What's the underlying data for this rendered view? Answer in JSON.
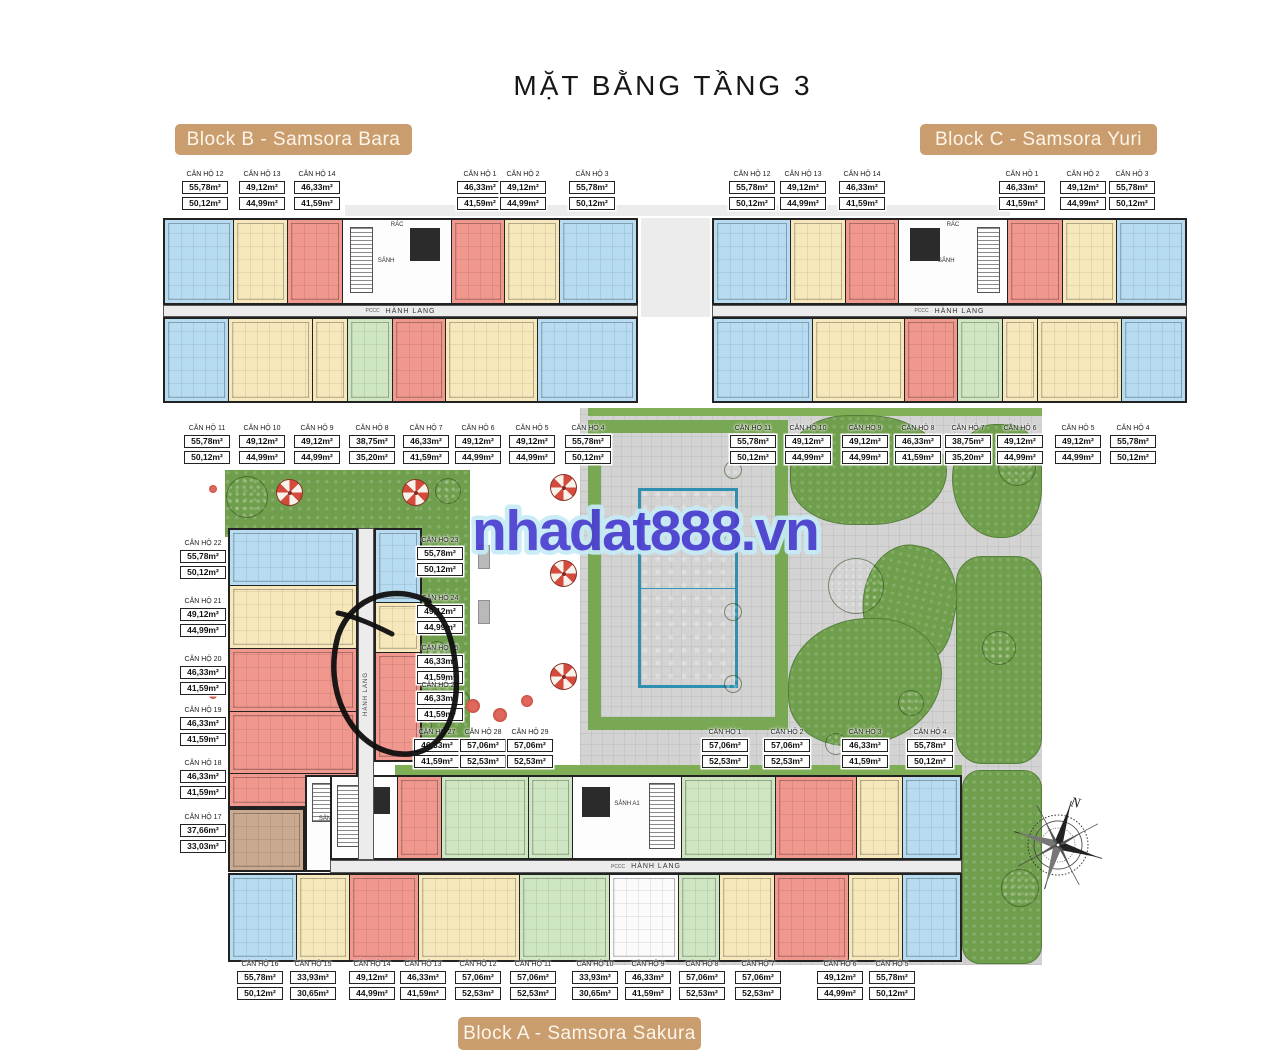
{
  "title": "MẶT BẰNG TẦNG 3",
  "watermark": "nhadat888.vn",
  "badges": {
    "block_b": "Block B - Samsora Bara",
    "block_c": "Block C - Samsora Yuri",
    "block_a": "Block A - Samsora Sakura"
  },
  "plan_texts": {
    "sanh": "SẢNH",
    "sanh_a1": "SẢNH A1",
    "sanh_a2": "SẢNH A2",
    "hanh_lang": "HÀNH LANG",
    "rac": "RÁC",
    "pccc": "PCCC"
  },
  "compass": {
    "label": "N"
  },
  "colors": {
    "accent_tan": "#c99d6e",
    "unit_blue": "#b7dcf2",
    "unit_cream": "#f7e8bc",
    "unit_red": "#f0978e",
    "unit_green": "#cfe6c2",
    "unit_brown": "#c9a98f",
    "pool": "#5fc9e2",
    "grass": "#7fae57",
    "garden": "#6f9e4c",
    "pavement": "#d3d3d3",
    "watermark_fill": "#4a3fd1",
    "watermark_outline": "#c6ebf6",
    "annotation": "#0f0f0f"
  },
  "label_groups": [
    {
      "name": "block-b-top",
      "labels": [
        {
          "unit": "CĂN HỘ 12",
          "area1": "55,78m²",
          "area2": "50,12m²",
          "x": 205,
          "y": 171
        },
        {
          "unit": "CĂN HỘ 13",
          "area1": "49,12m²",
          "area2": "44,99m²",
          "x": 262,
          "y": 171
        },
        {
          "unit": "CĂN HỘ 14",
          "area1": "46,33m²",
          "area2": "41,59m²",
          "x": 317,
          "y": 171
        },
        {
          "unit": "CĂN HỘ 1",
          "area1": "46,33m²",
          "area2": "41,59m²",
          "x": 480,
          "y": 171
        },
        {
          "unit": "CĂN HỘ 2",
          "area1": "49,12m²",
          "area2": "44,99m²",
          "x": 523,
          "y": 171
        },
        {
          "unit": "CĂN HỘ 3",
          "area1": "55,78m²",
          "area2": "50,12m²",
          "x": 592,
          "y": 171
        }
      ]
    },
    {
      "name": "block-c-top",
      "labels": [
        {
          "unit": "CĂN HỘ 12",
          "area1": "55,78m²",
          "area2": "50,12m²",
          "x": 752,
          "y": 171
        },
        {
          "unit": "CĂN HỘ 13",
          "area1": "49,12m²",
          "area2": "44,99m²",
          "x": 803,
          "y": 171
        },
        {
          "unit": "CĂN HỘ 14",
          "area1": "46,33m²",
          "area2": "41,59m²",
          "x": 862,
          "y": 171
        },
        {
          "unit": "CĂN HỘ 1",
          "area1": "46,33m²",
          "area2": "41,59m²",
          "x": 1022,
          "y": 171
        },
        {
          "unit": "CĂN HỘ 2",
          "area1": "49,12m²",
          "area2": "44,99m²",
          "x": 1083,
          "y": 171
        },
        {
          "unit": "CĂN HỘ 3",
          "area1": "55,78m²",
          "area2": "50,12m²",
          "x": 1132,
          "y": 171
        }
      ]
    },
    {
      "name": "block-b-mid",
      "labels": [
        {
          "unit": "CĂN HỘ 11",
          "area1": "55,78m²",
          "area2": "50,12m²",
          "x": 207,
          "y": 425
        },
        {
          "unit": "CĂN HỘ 10",
          "area1": "49,12m²",
          "area2": "44,99m²",
          "x": 262,
          "y": 425
        },
        {
          "unit": "CĂN HỘ 9",
          "area1": "49,12m²",
          "area2": "44,99m²",
          "x": 317,
          "y": 425
        },
        {
          "unit": "CĂN HỘ 8",
          "area1": "38,75m²",
          "area2": "35,20m²",
          "x": 372,
          "y": 425
        },
        {
          "unit": "CĂN HỘ 7",
          "area1": "46,33m²",
          "area2": "41,59m²",
          "x": 426,
          "y": 425
        },
        {
          "unit": "CĂN HỘ 6",
          "area1": "49,12m²",
          "area2": "44,99m²",
          "x": 478,
          "y": 425
        },
        {
          "unit": "CĂN HỘ 5",
          "area1": "49,12m²",
          "area2": "44,99m²",
          "x": 532,
          "y": 425
        },
        {
          "unit": "CĂN HỘ 4",
          "area1": "55,78m²",
          "area2": "50,12m²",
          "x": 588,
          "y": 425
        }
      ]
    },
    {
      "name": "block-c-mid",
      "labels": [
        {
          "unit": "CĂN HỘ 11",
          "area1": "55,78m²",
          "area2": "50,12m²",
          "x": 753,
          "y": 425
        },
        {
          "unit": "CĂN HỘ 10",
          "area1": "49,12m²",
          "area2": "44,99m²",
          "x": 808,
          "y": 425
        },
        {
          "unit": "CĂN HỘ 9",
          "area1": "49,12m²",
          "area2": "44,99m²",
          "x": 865,
          "y": 425
        },
        {
          "unit": "CĂN HỘ 8",
          "area1": "46,33m²",
          "area2": "41,59m²",
          "x": 918,
          "y": 425
        },
        {
          "unit": "CĂN HỘ 7",
          "area1": "38,75m²",
          "area2": "35,20m²",
          "x": 968,
          "y": 425
        },
        {
          "unit": "CĂN HỘ 6",
          "area1": "49,12m²",
          "area2": "44,99m²",
          "x": 1020,
          "y": 425
        },
        {
          "unit": "CĂN HỘ 5",
          "area1": "49,12m²",
          "area2": "44,99m²",
          "x": 1078,
          "y": 425
        },
        {
          "unit": "CĂN HỘ 4",
          "area1": "55,78m²",
          "area2": "50,12m²",
          "x": 1133,
          "y": 425
        }
      ]
    },
    {
      "name": "block-a-left",
      "labels": [
        {
          "unit": "CĂN HỘ 22",
          "area1": "55,78m²",
          "area2": "50,12m²",
          "x": 203,
          "y": 540
        },
        {
          "unit": "CĂN HỘ 21",
          "area1": "49,12m²",
          "area2": "44,99m²",
          "x": 203,
          "y": 598
        },
        {
          "unit": "CĂN HỘ 20",
          "area1": "46,33m²",
          "area2": "41,59m²",
          "x": 203,
          "y": 656
        },
        {
          "unit": "CĂN HỘ 19",
          "area1": "46,33m²",
          "area2": "41,59m²",
          "x": 203,
          "y": 707
        },
        {
          "unit": "CĂN HỘ 18",
          "area1": "46,33m²",
          "area2": "41,59m²",
          "x": 203,
          "y": 760
        },
        {
          "unit": "CĂN HỘ 17",
          "area1": "37,66m²",
          "area2": "33,03m²",
          "x": 203,
          "y": 814
        }
      ]
    },
    {
      "name": "block-a-center",
      "labels": [
        {
          "unit": "CĂN HỘ 23",
          "area1": "55,78m²",
          "area2": "50,12m²",
          "x": 440,
          "y": 537
        },
        {
          "unit": "CĂN HỘ 24",
          "area1": "49,12m²",
          "area2": "44,99m²",
          "x": 440,
          "y": 595
        },
        {
          "unit": "CĂN HỘ 25",
          "area1": "46,33m²",
          "area2": "41,59m²",
          "x": 440,
          "y": 645
        },
        {
          "unit": "CĂN HỘ 26",
          "area1": "46,33m²",
          "area2": "41,59m²",
          "x": 440,
          "y": 682
        }
      ]
    },
    {
      "name": "block-a-inner-row",
      "labels": [
        {
          "unit": "CĂN HỘ 27",
          "area1": "46,33m²",
          "area2": "41,59m²",
          "x": 437,
          "y": 729
        },
        {
          "unit": "CĂN HỘ 28",
          "area1": "57,06m²",
          "area2": "52,53m²",
          "x": 483,
          "y": 729
        },
        {
          "unit": "CĂN HỘ 29",
          "area1": "57,06m²",
          "area2": "52,53m²",
          "x": 530,
          "y": 729
        }
      ]
    },
    {
      "name": "block-a-right-row",
      "labels": [
        {
          "unit": "CĂN HỘ 1",
          "area1": "57,06m²",
          "area2": "52,53m²",
          "x": 725,
          "y": 729
        },
        {
          "unit": "CĂN HỘ 2",
          "area1": "57,06m²",
          "area2": "52,53m²",
          "x": 787,
          "y": 729
        },
        {
          "unit": "CĂN HỘ 3",
          "area1": "46,33m²",
          "area2": "41,59m²",
          "x": 865,
          "y": 729
        },
        {
          "unit": "CĂN HỘ 4",
          "area1": "55,78m²",
          "area2": "50,12m²",
          "x": 930,
          "y": 729
        }
      ]
    },
    {
      "name": "block-a-bottom",
      "labels": [
        {
          "unit": "CĂN HỘ 16",
          "area1": "55,78m²",
          "area2": "50,12m²",
          "x": 260,
          "y": 961
        },
        {
          "unit": "CĂN HỘ 15",
          "area1": "33,93m²",
          "area2": "30,65m²",
          "x": 313,
          "y": 961
        },
        {
          "unit": "CĂN HỘ 14",
          "area1": "49,12m²",
          "area2": "44,99m²",
          "x": 372,
          "y": 961
        },
        {
          "unit": "CĂN HỘ 13",
          "area1": "46,33m²",
          "area2": "41,59m²",
          "x": 423,
          "y": 961
        },
        {
          "unit": "CĂN HỘ 12",
          "area1": "57,06m²",
          "area2": "52,53m²",
          "x": 478,
          "y": 961
        },
        {
          "unit": "CĂN HỘ 11",
          "area1": "57,06m²",
          "area2": "52,53m²",
          "x": 533,
          "y": 961
        },
        {
          "unit": "CĂN HỘ 10",
          "area1": "33,93m²",
          "area2": "30,65m²",
          "x": 595,
          "y": 961
        },
        {
          "unit": "CĂN HỘ 9",
          "area1": "46,33m²",
          "area2": "41,59m²",
          "x": 648,
          "y": 961
        },
        {
          "unit": "CĂN HỘ 8",
          "area1": "57,06m²",
          "area2": "52,53m²",
          "x": 702,
          "y": 961
        },
        {
          "unit": "CĂN HỘ 7",
          "area1": "57,06m²",
          "area2": "52,53m²",
          "x": 758,
          "y": 961
        },
        {
          "unit": "CĂN HỘ 6",
          "area1": "49,12m²",
          "area2": "44,99m²",
          "x": 840,
          "y": 961
        },
        {
          "unit": "CĂN HỘ 5",
          "area1": "55,78m²",
          "area2": "50,12m²",
          "x": 892,
          "y": 961
        }
      ]
    }
  ]
}
